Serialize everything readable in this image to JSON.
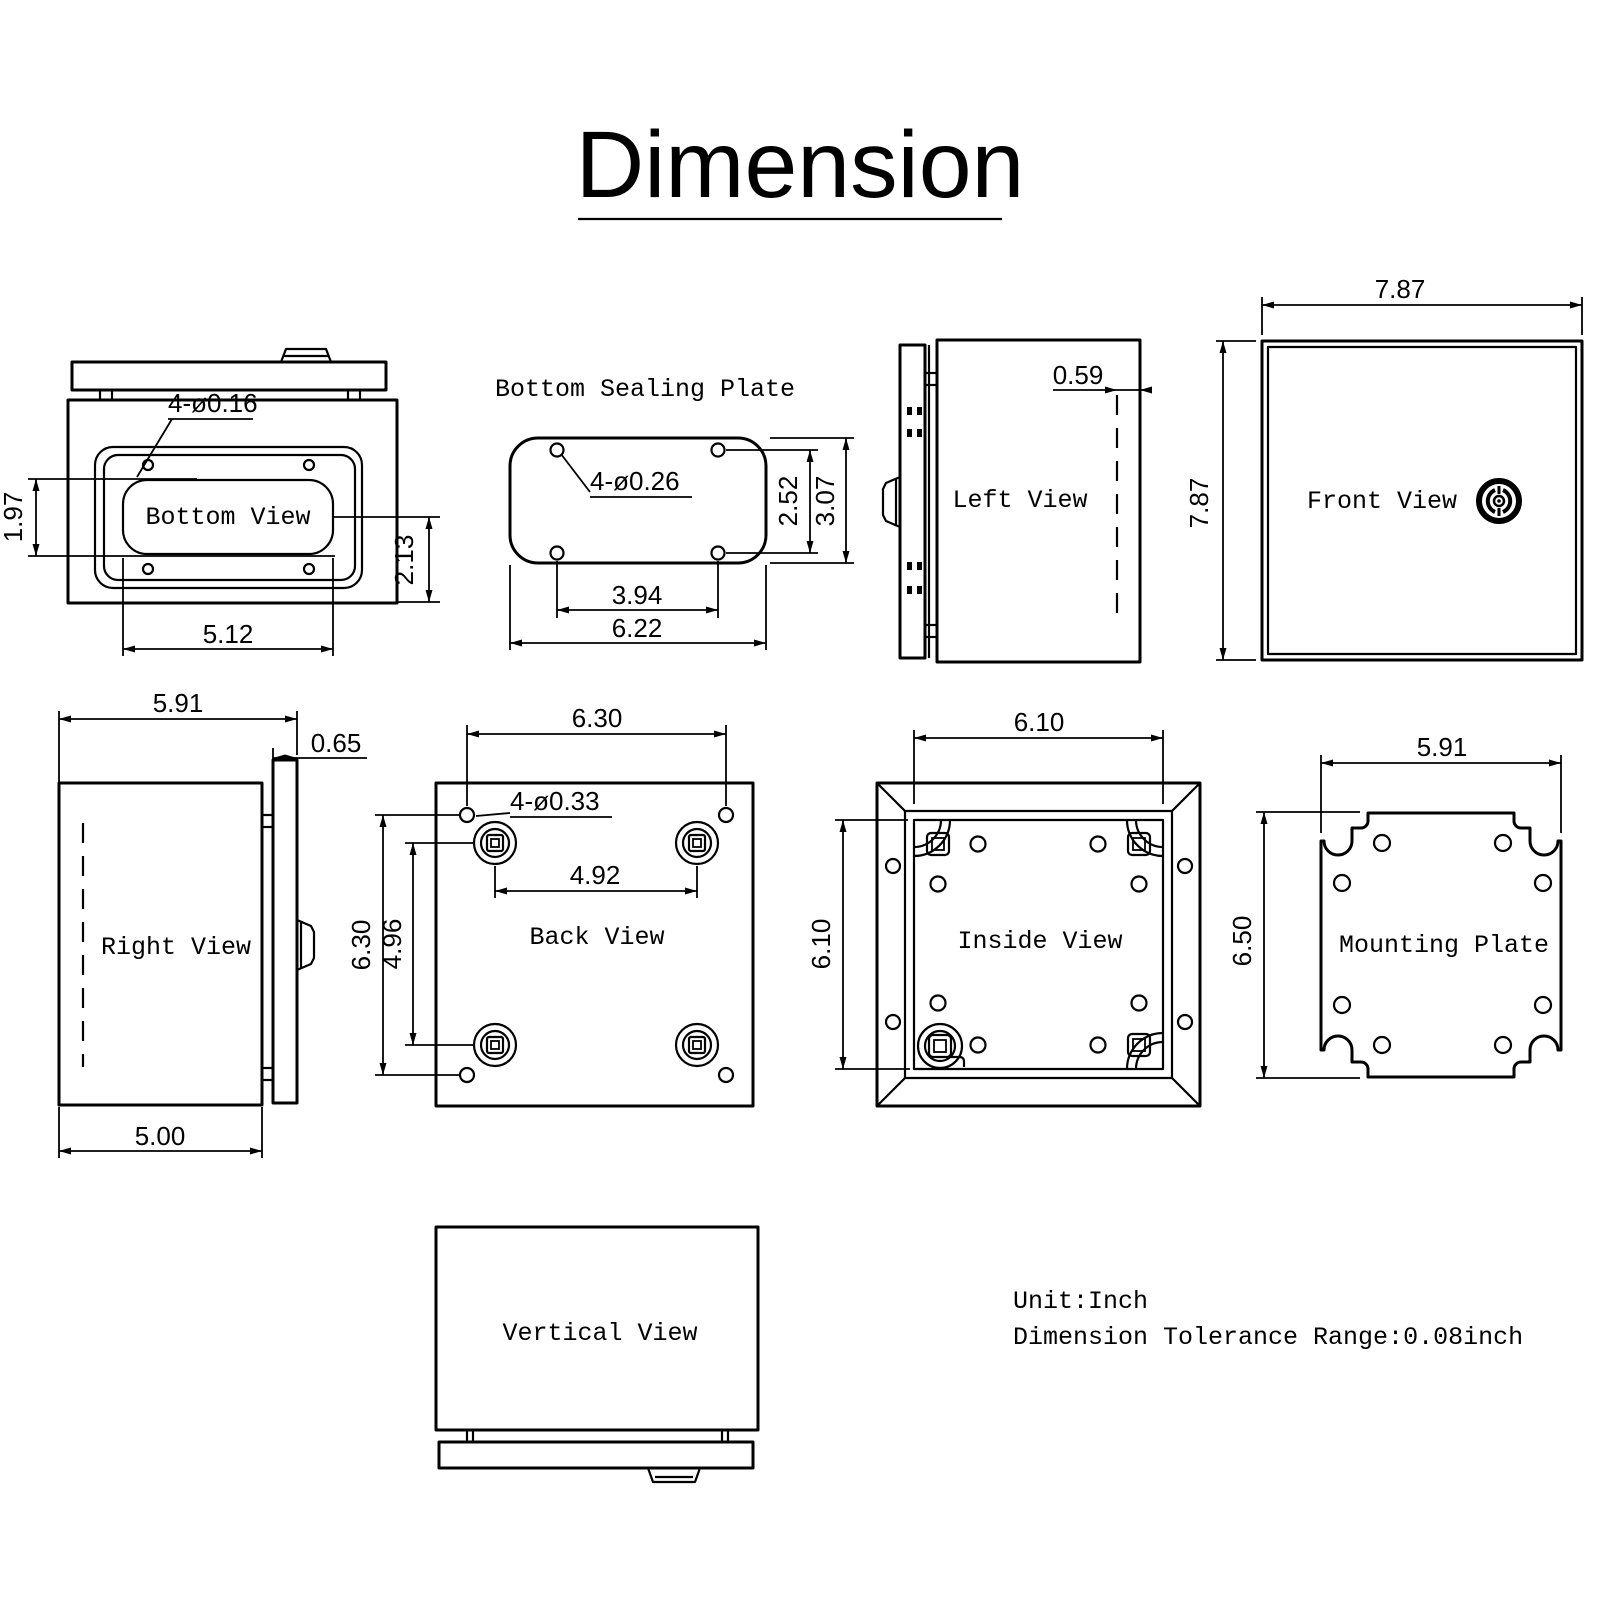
{
  "title": {
    "text": "Dimension"
  },
  "footer": {
    "unit": "Unit:Inch",
    "tolerance": "Dimension Tolerance Range:0.08inch"
  },
  "colors": {
    "ink": "#000000",
    "background": "#ffffff"
  },
  "views": {
    "bottom_view": {
      "label": "Bottom View",
      "dims": {
        "holes": "4-ø0.16",
        "cutout_height": "1.97",
        "side_height": "2.13",
        "width": "5.12"
      }
    },
    "bottom_sealing_plate": {
      "label": "Bottom Sealing Plate",
      "dims": {
        "holes": "4-ø0.26",
        "hole_spacing_v": "2.52",
        "height": "3.07",
        "hole_spacing_h": "3.94",
        "width": "6.22"
      }
    },
    "left_view": {
      "label": "Left View",
      "dims": {
        "lid_inset": "0.59"
      }
    },
    "front_view": {
      "label": "Front View",
      "dims": {
        "width": "7.87",
        "height": "7.87"
      }
    },
    "right_view": {
      "label": "Right View",
      "dims": {
        "total_depth": "5.91",
        "lid_depth": "0.65",
        "body_depth": "5.00"
      }
    },
    "back_view": {
      "label": "Back View",
      "dims": {
        "holes": "4-ø0.33",
        "hole_spacing_h": "6.30",
        "boss_spacing_h": "4.92",
        "hole_spacing_v": "6.30",
        "boss_spacing_v": "4.96"
      }
    },
    "inside_view": {
      "label": "Inside View",
      "dims": {
        "width": "6.10",
        "height": "6.10"
      }
    },
    "mounting_plate": {
      "label": "Mounting Plate",
      "dims": {
        "width": "5.91",
        "height": "6.50"
      }
    },
    "vertical_view": {
      "label": "Vertical View"
    }
  }
}
